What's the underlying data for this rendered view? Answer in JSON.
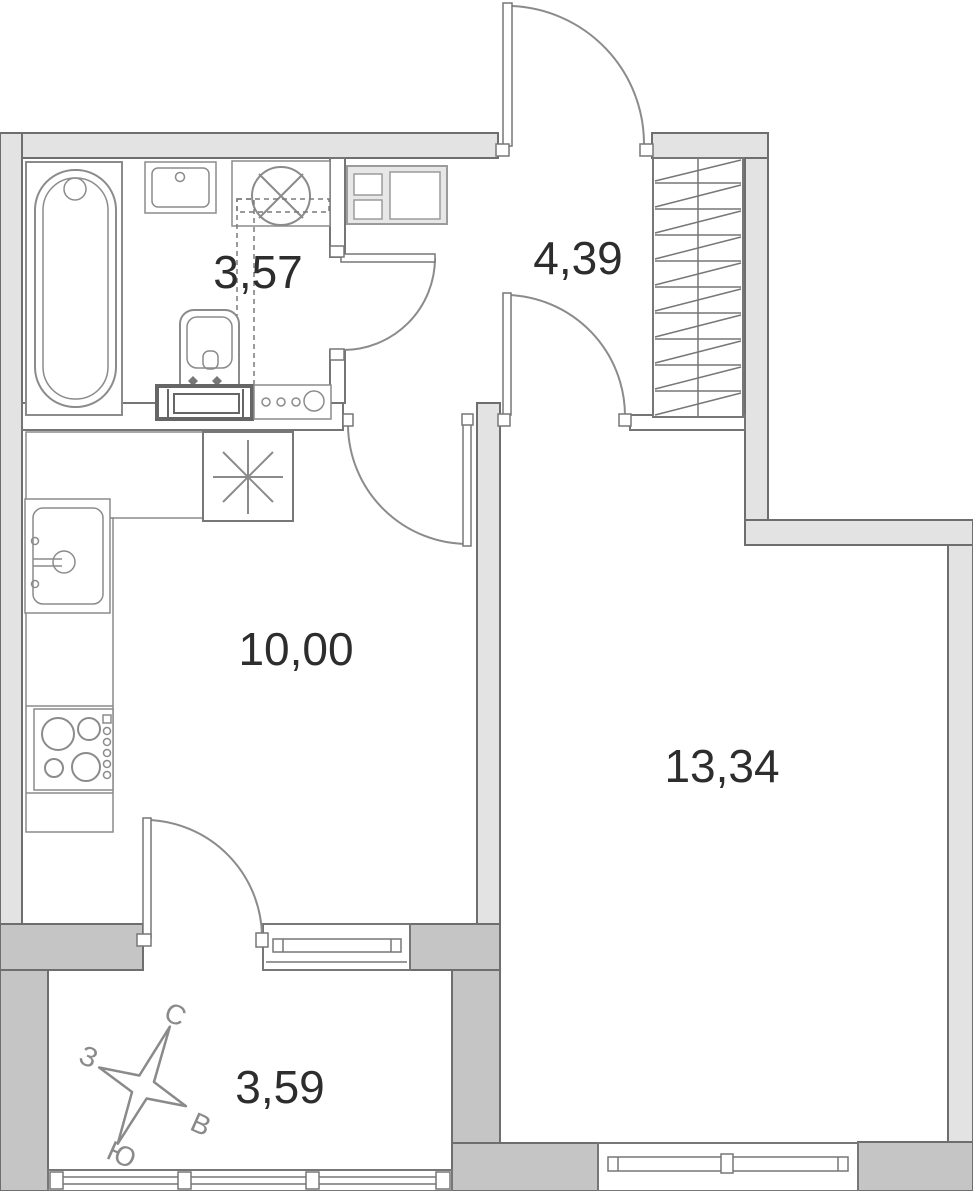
{
  "plan": {
    "rooms": [
      {
        "id": "bathroom",
        "area": "3,57"
      },
      {
        "id": "hallway",
        "area": "4,39"
      },
      {
        "id": "kitchen",
        "area": "10,00"
      },
      {
        "id": "living-room",
        "area": "13,34"
      },
      {
        "id": "balcony",
        "area": "3,59"
      }
    ],
    "compass": {
      "north": "С",
      "west": "З",
      "east": "В",
      "south": "Ю"
    },
    "colors": {
      "wall_light": "#e3e3e3",
      "wall_dark": "#c5c5c5",
      "wall_outline": "#6e6e6e",
      "fixture_stroke": "#8b8b8b",
      "label_text": "#2d2d2d",
      "compass_gray": "#8a8a8a"
    }
  }
}
